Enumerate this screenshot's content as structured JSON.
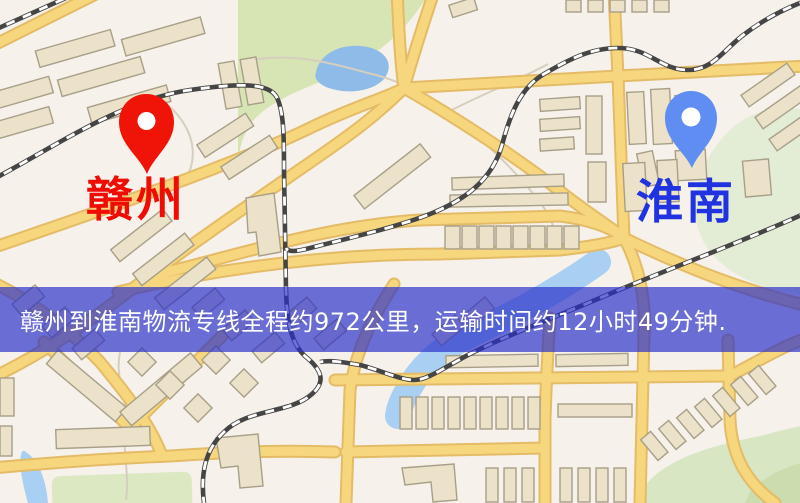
{
  "markers": {
    "origin": {
      "label": "赣州",
      "pin_color": "#f01408",
      "label_color": "#ef0c03"
    },
    "destination": {
      "label": "淮南",
      "pin_color": "#5f8df2",
      "label_color": "#2133e0"
    }
  },
  "banner": {
    "text": "赣州到淮南物流专线全程约972公里，运输时间约12小时49分钟.",
    "background": "#282dc8",
    "opacity": "0.68",
    "text_color": "#ffffff"
  },
  "map_palette": {
    "background": "#f6f1ea",
    "road_fill": "#f7d77e",
    "road_casing": "#e4bb66",
    "building_fill": "#ebe2c9",
    "building_stroke": "#a89f88",
    "park_green": "#d7e5b5",
    "water_blue": "#9ec7ee",
    "railway_dark": "#454545"
  }
}
